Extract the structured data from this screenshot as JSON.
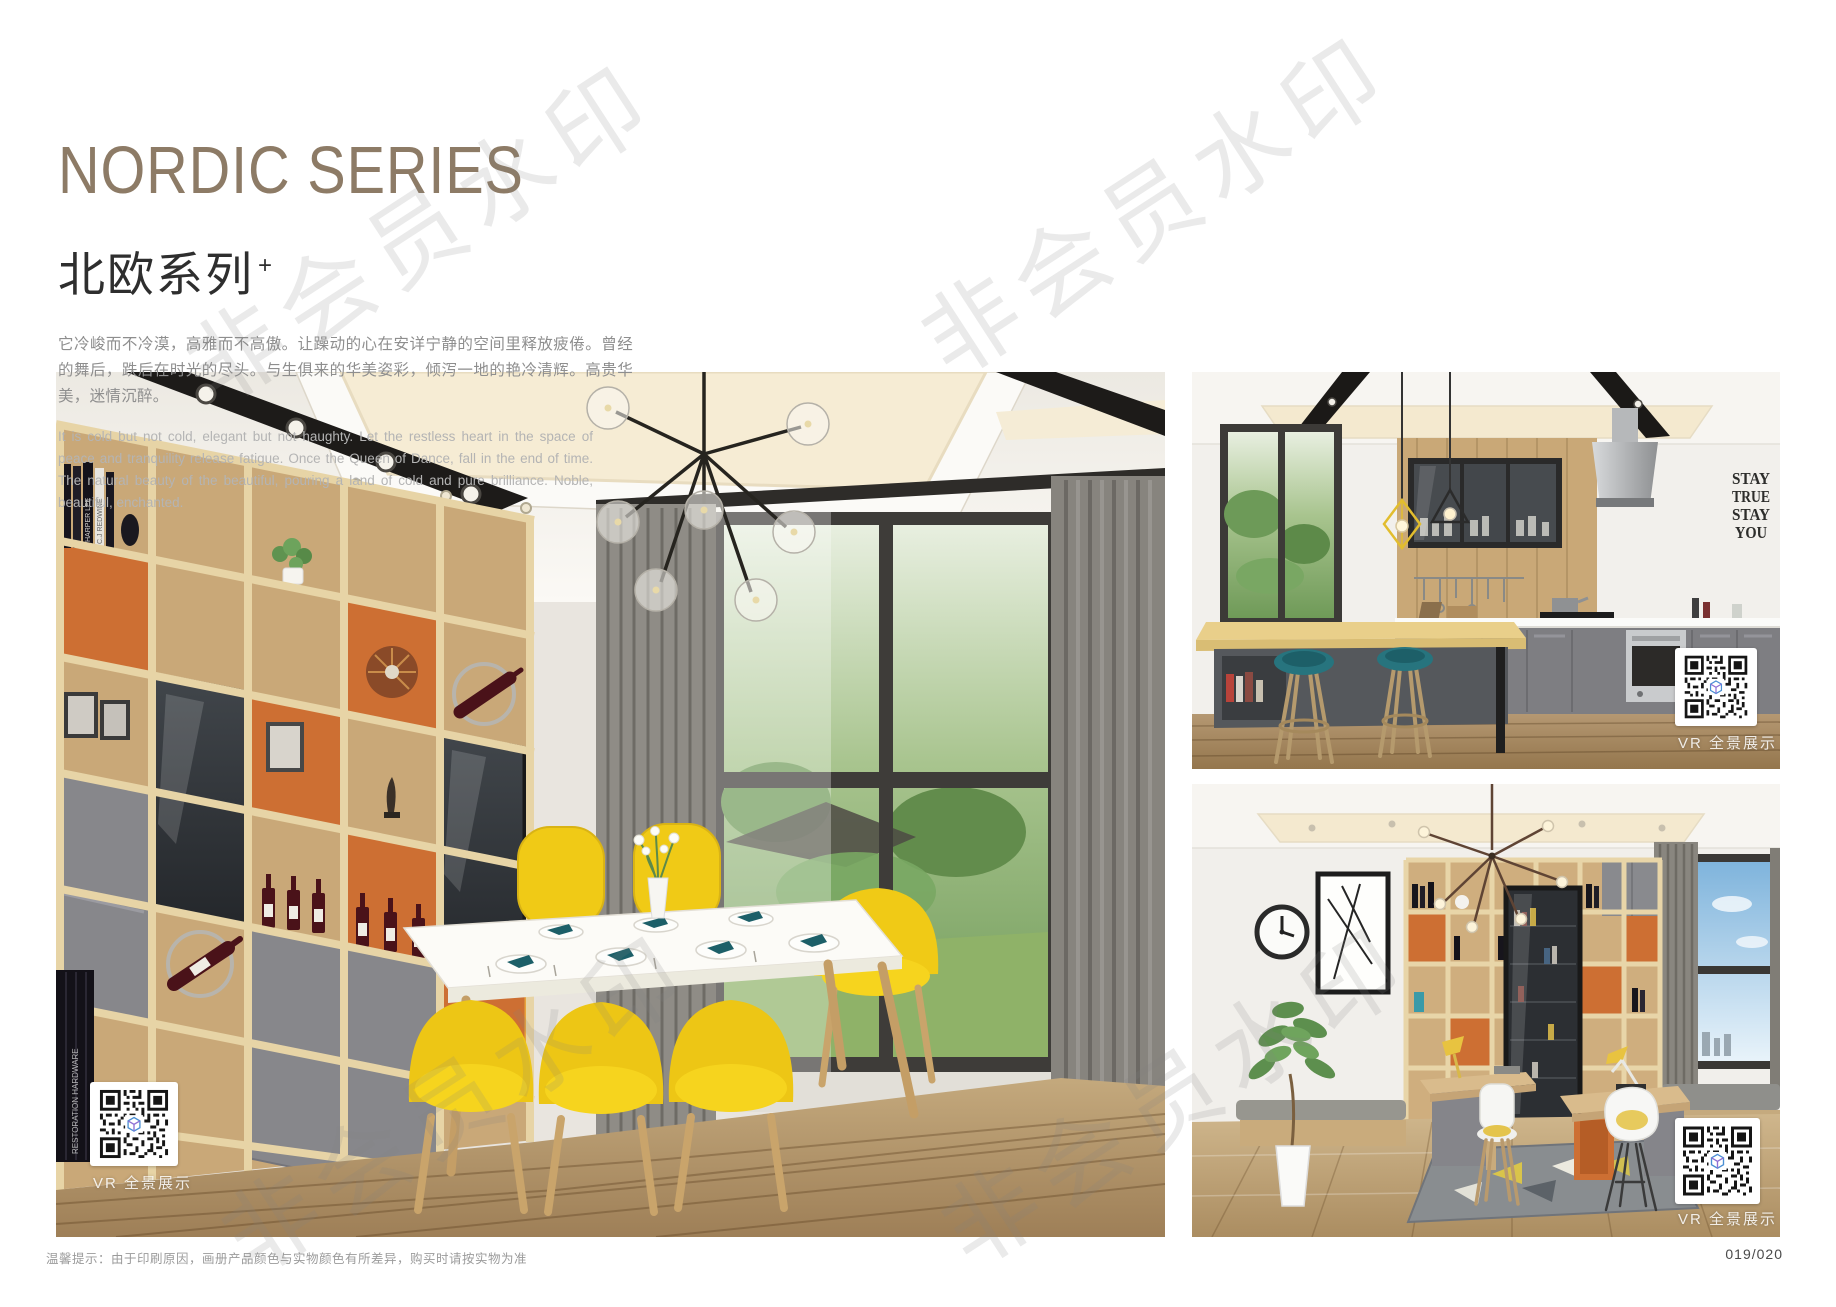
{
  "header": {
    "title_en": "NORDIC SERIES",
    "title_zh": "北欧系列",
    "title_superscript": "+",
    "paragraph_zh": "它冷峻而不冷漠，高雅而不高傲。让躁动的心在安详宁静的空间里释放疲倦。曾经的舞后，跌后在时光的尽头。与生俱来的华美姿彩，倾泻一地的艳冷清辉。高贵华美，迷情沉醉。",
    "paragraph_en": "It is cold but not cold, elegant but not haughty. Let the restless heart in the space of peace and tranquility release fatigue. Once the Queen of Dance, fall in the end of time. The natural beauty of the beautiful, pouring a land of cold and pure brilliance. Noble, beautiful, enchanted."
  },
  "watermark": {
    "text": "非会员水印"
  },
  "photos": {
    "dining": {
      "vr_label": "VR 全景展示",
      "book_spines": [
        "C.J REDWINE",
        "HARPER LEE"
      ],
      "black_books_label": "RESTORATION HARDWARE"
    },
    "kitchen": {
      "vr_label": "VR 全景展示",
      "decal": [
        "STAY",
        "TRUE",
        "STAY",
        "YOU"
      ]
    },
    "study": {
      "vr_label": "VR 全景展示"
    }
  },
  "footer": {
    "note": "温馨提示：由于印刷原因，画册产品颜色与实物颜色有所差异，购买时请按实物为准",
    "page_number": "019/020"
  },
  "palette": {
    "title_brown": "#8d7b66",
    "accent_orange": "#cd6f33",
    "chair_yellow": "#f3ce17",
    "stool_teal": "#27747e",
    "cabinet_gray": "#85858a",
    "oak_wood": "#cfae7e"
  }
}
